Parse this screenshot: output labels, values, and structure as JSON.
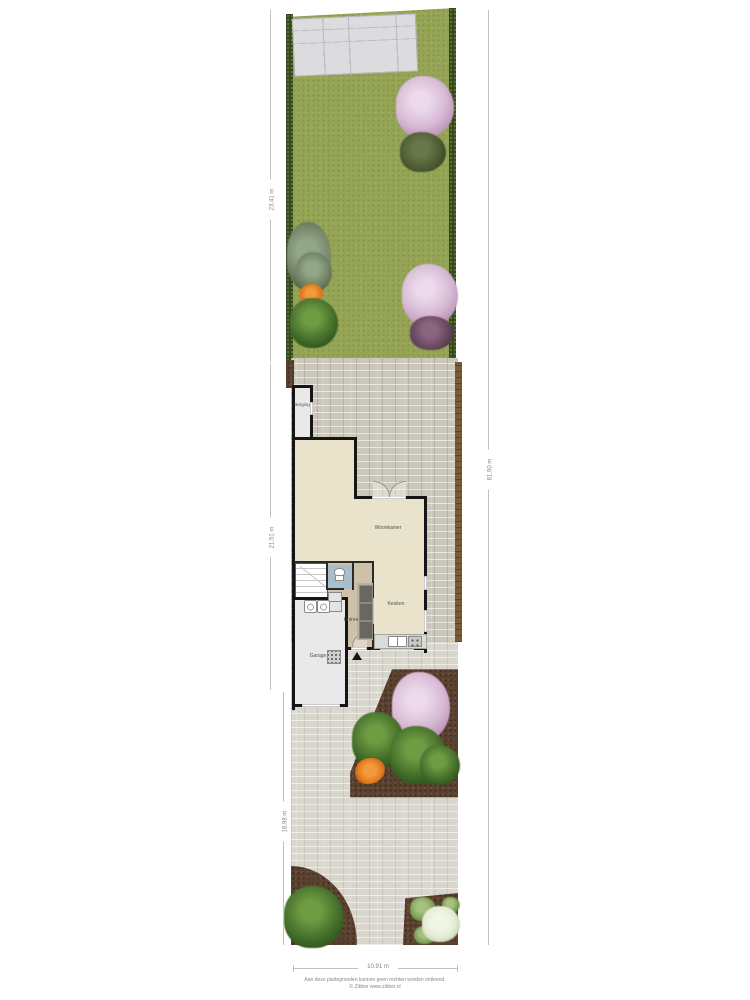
{
  "plan": {
    "type": "situatie-begane-grond-plattegrond",
    "rooms": [
      {
        "id": "woonkamer",
        "label": "Woonkamer"
      },
      {
        "id": "keuken",
        "label": "Keuken"
      },
      {
        "id": "entree",
        "label": "Entree"
      },
      {
        "id": "garage",
        "label": "Garage"
      },
      {
        "id": "berging",
        "label": "Berging"
      }
    ],
    "dimensions": {
      "garden_depth": "23.41 m",
      "house_section_depth": "21.51 m",
      "front_yard_depth": "16.98 m",
      "total_depth": "61.90 m",
      "plot_width": "10.91 m"
    },
    "footer": {
      "disclaimer": "Aan deze plattegronden kunnen geen rechten worden ontleend.",
      "credit": "© Zibber www.zibber.nl"
    },
    "colors": {
      "grass": "#95a455",
      "hedge": "#35491f",
      "tile": "#dcdcdf",
      "brick": "#cbc7bb",
      "floor": "#eae3cb",
      "hall": "#cfc0a8",
      "utility": "#e9e9e9",
      "toiletfloor": "#aabdcd",
      "wall": "#151515",
      "dirt": "#5a4130",
      "fence": "#7a5a38",
      "blossom": "#d8bbd6",
      "bush": "#3f6a28",
      "flower": "#e0761c"
    }
  }
}
